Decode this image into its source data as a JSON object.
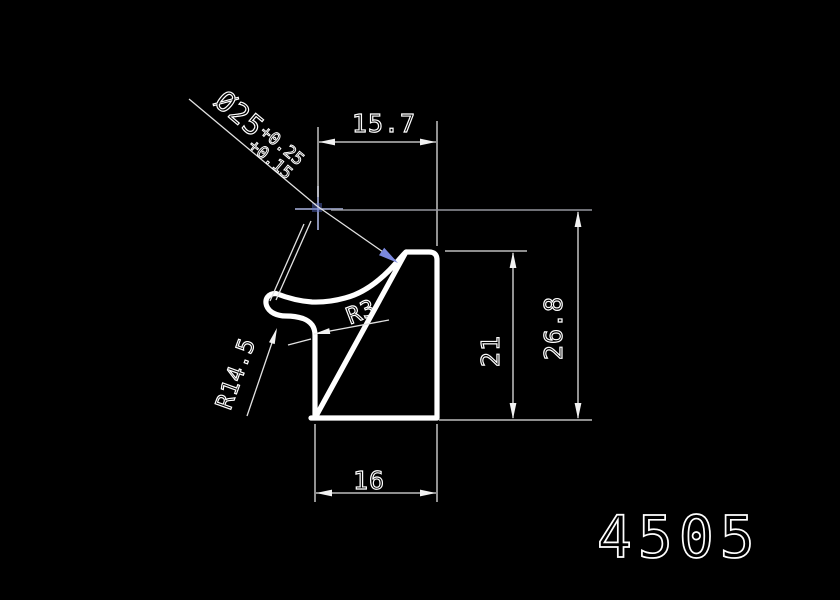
{
  "canvas": {
    "background": "#000000",
    "line_color": "#ffffff",
    "highlight_color": "#7b89e0",
    "center_mark_color": "#aab4e0",
    "extension_gray": "#94969e"
  },
  "part": {
    "number": "4505"
  },
  "dimensions": {
    "top_width": {
      "label": "15.7"
    },
    "overall_height": {
      "label": "26.8"
    },
    "side_height": {
      "label": "21"
    },
    "bottom_width": {
      "label": "16"
    },
    "fillet_radius": {
      "label": "R3"
    },
    "hook_radius": {
      "label": "R14.5"
    },
    "bore": {
      "label": "Ø25",
      "tolerance_upper": "+0.25",
      "tolerance_lower": "+0.15"
    }
  }
}
